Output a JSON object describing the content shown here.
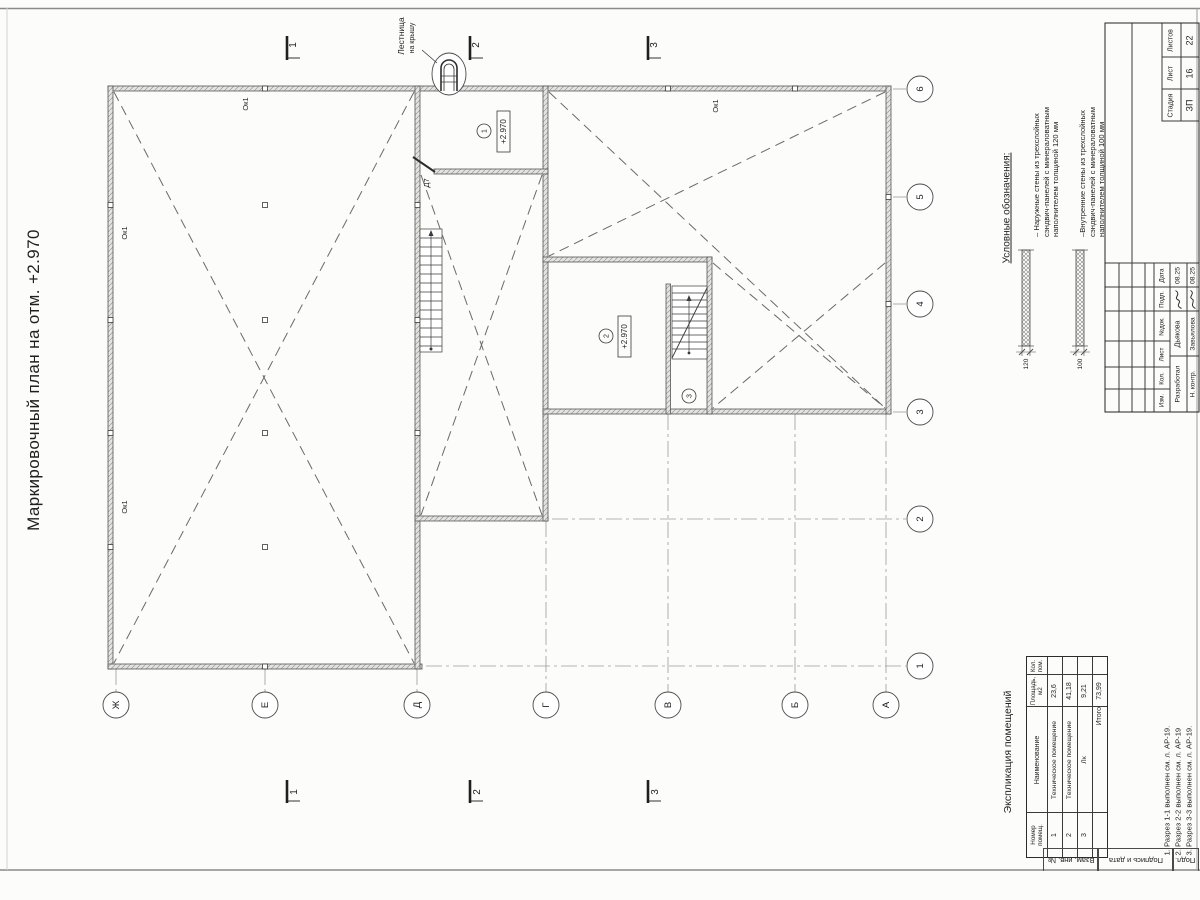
{
  "sheet": {
    "title": "Маркировочный план на отм. +2.970"
  },
  "plan": {
    "axes_letters": [
      "Ж",
      "Е",
      "Д",
      "Г",
      "В",
      "Б",
      "А"
    ],
    "axes_numbers": [
      "1",
      "2",
      "3",
      "4",
      "5",
      "6"
    ],
    "section_marks": [
      "1",
      "2",
      "3"
    ],
    "elevation_mark": "+2.970",
    "room_tags": [
      "1",
      "2",
      "3"
    ],
    "window_label": "Ок1",
    "door_label": "Д7",
    "ladder_label_1": "Лестница",
    "ladder_label_2": "на крышу"
  },
  "legend": {
    "title": "Условные обозначения:",
    "items": [
      {
        "text": "– Наружные стены из трехслойных\nсэндвич-панелей с минераловатным\nнаполнителем толщиной 120 мм",
        "dim": "120"
      },
      {
        "text": "–Внутренние стены из трехслойных\nсэндвич-панелей с минераловатным\nнаполнителем толщиной 100 мм",
        "dim": "100"
      }
    ]
  },
  "schedule": {
    "title": "Экспликация помещений",
    "headers": [
      "Номер\nпомещ.",
      "Наименование",
      "Площадь,\nм2",
      "Кол.\nпом."
    ],
    "rows": [
      [
        "1",
        "Техническое помещение",
        "23,6"
      ],
      [
        "2",
        "Техническое помещение",
        "41,18"
      ],
      [
        "3",
        "Лк",
        "9,21"
      ]
    ],
    "total_label": "Итого",
    "total_value": "73,99"
  },
  "notes": [
    "1. Разрез 1-1 выполнен см. л. АР-19.",
    "2. Разрез 2-2 выполнен см. л. АР-19",
    "3. Разрез 3-3 выполнен см. л. АР-19."
  ],
  "stamp": {
    "headers": {
      "izm": "Изм.",
      "kol": "Кол.",
      "list": "Лист",
      "ndok": "№док.",
      "podp": "Подп.",
      "data": "Дата"
    },
    "rows": [
      {
        "role": "Разработал",
        "name": "Дьякова",
        "date": "08.25"
      },
      {
        "role": "Н. контр.",
        "name": "Завьялова",
        "date": "08.25"
      }
    ],
    "stage_label": "Стадия",
    "sheet_label": "Лист",
    "sheets_label": "Листов",
    "stage": "ЗП",
    "sheet": "16",
    "sheets": "22"
  },
  "margin_boxes": [
    "Взам. инв. №",
    "Подпись и дата",
    "Подл."
  ]
}
